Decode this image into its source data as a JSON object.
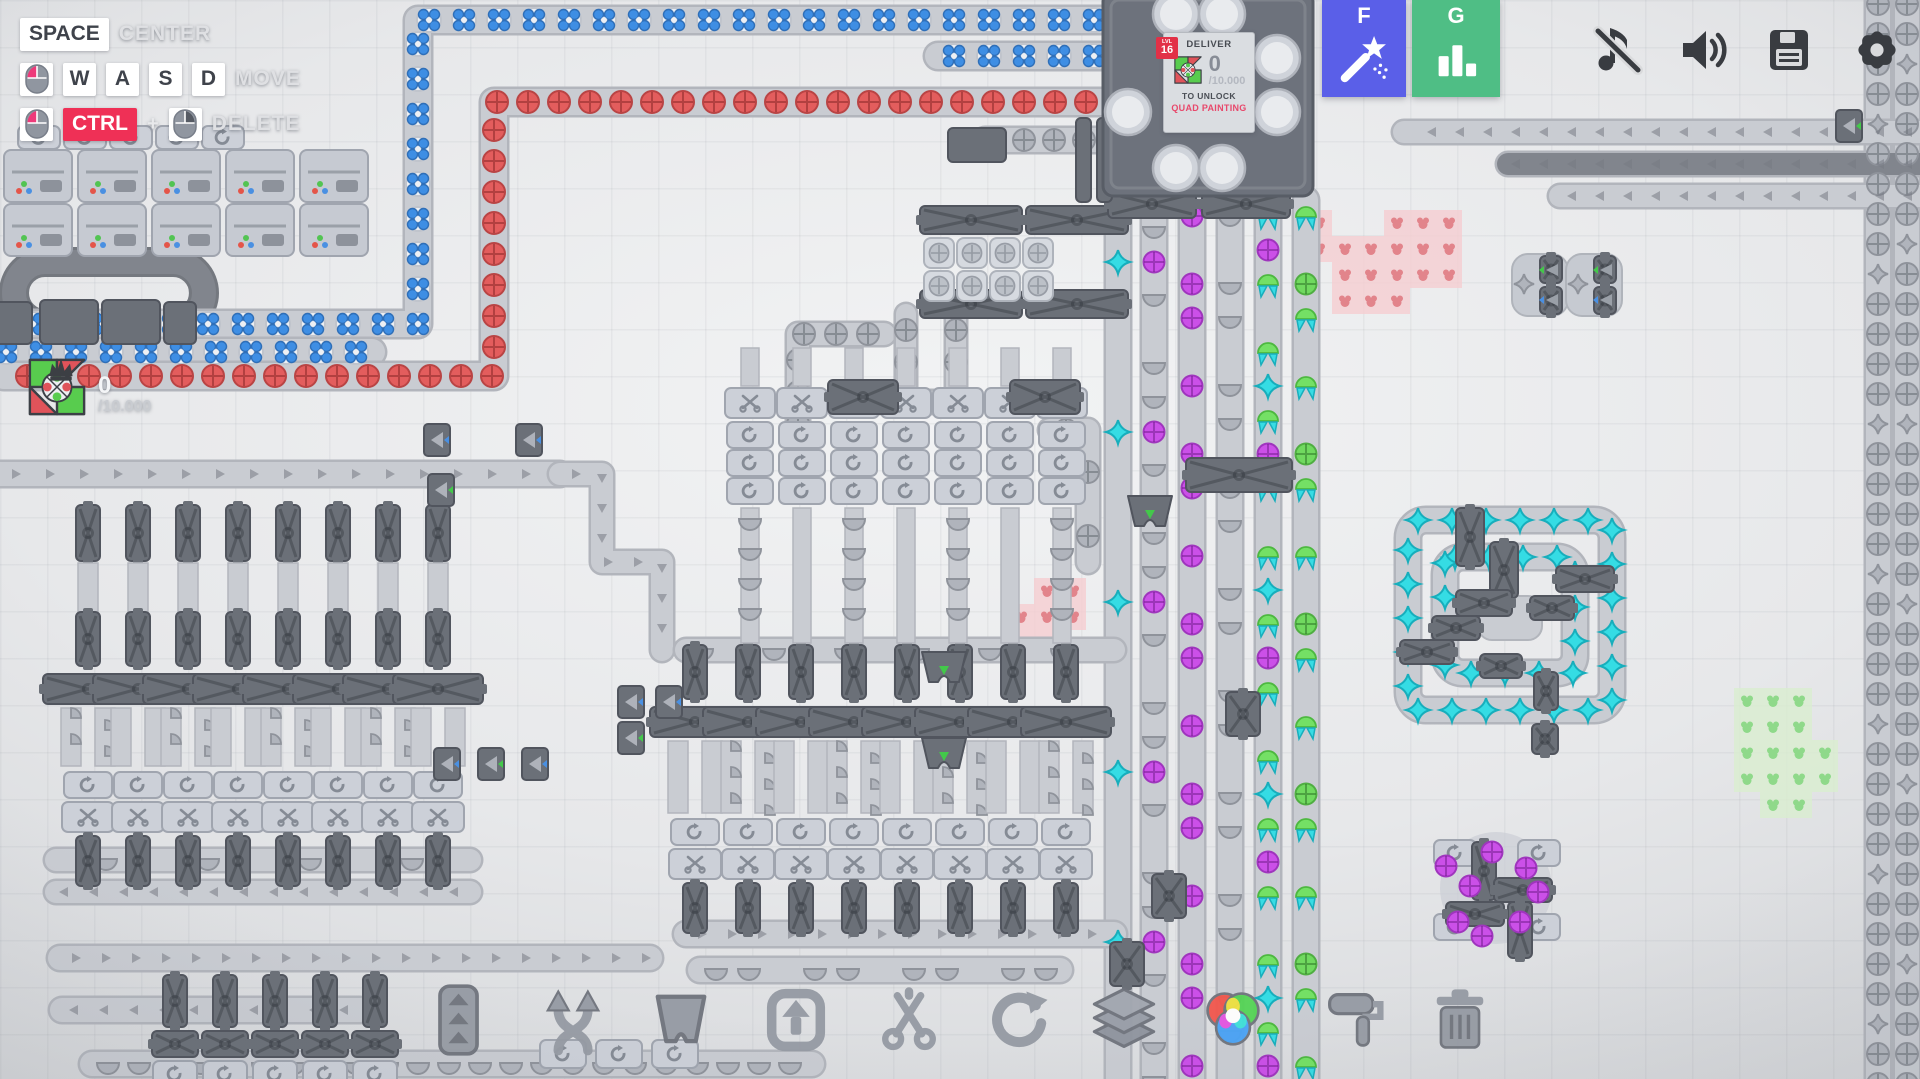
{
  "colors": {
    "accent_wand": "#5a5fe8",
    "accent_stats": "#4fbe85",
    "ctrl_chip": "#ef3056",
    "reward_text": "#e8486b",
    "item_blue": "#3e8ee4",
    "item_red": "#e35d5d",
    "item_purple": "#cb50e8",
    "item_green": "#70d95f",
    "item_cyan": "#35dce4",
    "item_gray": "#b0b4bc",
    "pink_tile": "#f5cdd1",
    "pink_dot": "#e2848b",
    "green_tile": "#daeecf",
    "green_dot": "#8fd98a",
    "machine_dark": "#6b7078",
    "machine_light": "#ccd0d8",
    "belt": "#c9ccd2"
  },
  "keybinds": {
    "space": "SPACE",
    "center": "CENTER",
    "move_keys": [
      "W",
      "A",
      "S",
      "D"
    ],
    "move": "MOVE",
    "ctrl": "CTRL",
    "plus": "+",
    "delete": "DELETE"
  },
  "hub": {
    "level_label": "LVL",
    "level": "16",
    "deliver": "DELIVER",
    "count": "0",
    "goal": "/10.000",
    "unlock": "TO UNLOCK",
    "reward": "QUAD PAINTING"
  },
  "side_counter": {
    "count": "0",
    "goal": "/10.000"
  },
  "hotkeys": {
    "wand": "F",
    "stats": "G"
  },
  "top_icons": [
    "music-muted",
    "volume",
    "save",
    "settings"
  ],
  "toolbar_icons": [
    "belt",
    "belt-swap",
    "tunnel",
    "lift",
    "cut",
    "rotate",
    "layers",
    "color-mixer",
    "paint",
    "trash"
  ],
  "scene": {
    "belts": [
      {
        "pts": [
          [
            1110,
            20
          ],
          [
            418,
            20
          ],
          [
            418,
            324
          ],
          [
            -12,
            324
          ]
        ],
        "w": 26,
        "sp": 35,
        "seq": [
          "blue-flower"
        ]
      },
      {
        "pts": [
          [
            1110,
            56
          ],
          [
            938,
            56
          ]
        ],
        "w": 26,
        "sp": 35,
        "seq": [
          "blue-flower"
        ]
      },
      {
        "pts": [
          [
            372,
            352
          ],
          [
            -12,
            352
          ]
        ],
        "w": 26,
        "sp": 35,
        "seq": [
          "blue-flower"
        ]
      },
      {
        "pts": [
          [
            1102,
            102
          ],
          [
            494,
            102
          ],
          [
            494,
            376
          ],
          [
            4,
            376
          ]
        ],
        "w": 26,
        "sp": 31,
        "seq": [
          "red-circle"
        ]
      },
      {
        "pts": [
          [
            1100,
            140
          ],
          [
            985,
            140
          ]
        ],
        "w": 24,
        "sp": 30,
        "seq": [
          "gray-circle"
        ]
      },
      {
        "pts": [
          [
            1878,
            -12
          ],
          [
            1878,
            1085
          ]
        ],
        "w": 24,
        "sp": 30,
        "seq": [
          "gray-circle",
          "gray-circle",
          "gray-circle",
          "gray-circle",
          "gray-star"
        ]
      },
      {
        "pts": [
          [
            1907,
            -12
          ],
          [
            1907,
            1085
          ]
        ],
        "w": 24,
        "sp": 30,
        "seq": [
          "gray-circle",
          "gray-circle",
          "gray-star",
          "gray-circle",
          "gray-circle",
          "gray-circle"
        ]
      },
      {
        "pts": [
          [
            1924,
            132
          ],
          [
            1404,
            132
          ]
        ],
        "w": 22,
        "sp": 28,
        "seq": [
          "chev"
        ]
      },
      {
        "pts": [
          [
            1924,
            164
          ],
          [
            1508,
            164
          ]
        ],
        "w": 22,
        "sp": 28,
        "seq": [
          "chev"
        ],
        "dark": true
      },
      {
        "pts": [
          [
            1924,
            196
          ],
          [
            1560,
            196
          ]
        ],
        "w": 22,
        "sp": 28,
        "seq": [
          "chev"
        ]
      },
      {
        "pts": [
          [
            1118,
            212
          ],
          [
            1118,
            1085
          ]
        ],
        "w": 24,
        "sp": 34,
        "seq": [
          "none",
          "cyan-star",
          "none",
          "none",
          "none"
        ]
      },
      {
        "pts": [
          [
            1154,
            212
          ],
          [
            1154,
            1085
          ]
        ],
        "w": 24,
        "sp": 34,
        "seq": [
          "gray-half",
          "purple-circle",
          "gray-half",
          "none",
          "gray-half"
        ]
      },
      {
        "pts": [
          [
            1192,
            200
          ],
          [
            1192,
            1085
          ]
        ],
        "w": 24,
        "sp": 34,
        "seq": [
          "purple-circle",
          "none",
          "purple-circle",
          "purple-circle",
          "none"
        ]
      },
      {
        "pts": [
          [
            1230,
            200
          ],
          [
            1230,
            1085
          ]
        ],
        "w": 24,
        "sp": 34,
        "seq": [
          "gray-half",
          "none",
          "gray-half",
          "gray-half",
          "none",
          "gray-half"
        ]
      },
      {
        "pts": [
          [
            1268,
            200
          ],
          [
            1268,
            1085
          ]
        ],
        "w": 24,
        "sp": 34,
        "seq": [
          "green-moth",
          "purple-circle",
          "green-moth",
          "none",
          "green-moth",
          "cyan-star"
        ]
      },
      {
        "pts": [
          [
            1306,
            200
          ],
          [
            1306,
            1085
          ]
        ],
        "w": 24,
        "sp": 34,
        "seq": [
          "green-moth",
          "none",
          "green-circle",
          "green-moth",
          "none"
        ]
      },
      {
        "pts": [
          [
            884,
            334
          ],
          [
            798,
            334
          ],
          [
            798,
            476
          ]
        ],
        "w": 22,
        "sp": 32,
        "seq": [
          "gray-circle"
        ]
      },
      {
        "pts": [
          [
            852,
            402
          ],
          [
            940,
            402
          ]
        ],
        "w": 22,
        "sp": 32,
        "seq": [
          "gray-circle",
          "gray-circle",
          "none"
        ]
      },
      {
        "pts": [
          [
            906,
            314
          ],
          [
            906,
            388
          ]
        ],
        "w": 20,
        "sp": 32,
        "seq": [
          "gray-circle"
        ]
      },
      {
        "pts": [
          [
            956,
            314
          ],
          [
            956,
            388
          ]
        ],
        "w": 20,
        "sp": 32,
        "seq": [
          "gray-circle"
        ]
      },
      {
        "pts": [
          [
            1050,
            430
          ],
          [
            1088,
            430
          ],
          [
            1088,
            562
          ]
        ],
        "w": 22,
        "sp": 32,
        "seq": [
          "gray-circle",
          "none"
        ]
      },
      {
        "pts": [
          [
            0,
            474
          ],
          [
            560,
            474
          ]
        ],
        "w": 24,
        "sp": 34,
        "seq": [
          "chev"
        ]
      },
      {
        "pts": [
          [
            560,
            474
          ],
          [
            602,
            474
          ],
          [
            602,
            562
          ],
          [
            662,
            562
          ],
          [
            662,
            650
          ]
        ],
        "w": 22,
        "sp": 30,
        "seq": [
          "chev"
        ]
      },
      {
        "pts": [
          [
            470,
            892
          ],
          [
            56,
            892
          ]
        ],
        "w": 22,
        "sp": 30,
        "seq": [
          "chev"
        ]
      },
      {
        "pts": [
          [
            56,
            860
          ],
          [
            470,
            860
          ]
        ],
        "w": 22,
        "sp": 34,
        "seq": [
          "none",
          "gray-half",
          "none"
        ]
      },
      {
        "pts": [
          [
            60,
            958
          ],
          [
            650,
            958
          ]
        ],
        "w": 24,
        "sp": 30,
        "seq": [
          "chev"
        ]
      },
      {
        "pts": [
          [
            92,
            1064
          ],
          [
            812,
            1064
          ]
        ],
        "w": 24,
        "sp": 31,
        "seq": [
          "gray-half"
        ]
      },
      {
        "pts": [
          [
            686,
            650
          ],
          [
            1114,
            650
          ]
        ],
        "w": 22,
        "sp": 36,
        "seq": [
          "gray-half",
          "none"
        ]
      },
      {
        "pts": [
          [
            686,
            934
          ],
          [
            1114,
            934
          ]
        ],
        "w": 24,
        "sp": 30,
        "seq": [
          "chev"
        ]
      },
      {
        "pts": [
          [
            700,
            970
          ],
          [
            1060,
            970
          ]
        ],
        "w": 24,
        "sp": 33,
        "seq": [
          "gray-half",
          "gray-half",
          "none"
        ]
      },
      {
        "pts": [
          [
            360,
            1010
          ],
          [
            62,
            1010
          ]
        ],
        "w": 24,
        "sp": 30,
        "seq": [
          "chev"
        ]
      }
    ],
    "loop": {
      "x": 14,
      "y": 262,
      "w": 190,
      "h": 62
    },
    "xsplits": [
      [
        920,
        206,
        102,
        28
      ],
      [
        1026,
        206,
        102,
        28
      ],
      [
        920,
        290,
        102,
        28
      ],
      [
        1026,
        290,
        102,
        28
      ],
      [
        828,
        380,
        70,
        34
      ],
      [
        1010,
        380,
        70,
        34
      ],
      [
        1108,
        190,
        88,
        28
      ],
      [
        1202,
        190,
        88,
        28
      ],
      [
        1186,
        458,
        106,
        34
      ],
      [
        1110,
        942,
        34,
        44
      ],
      [
        1226,
        692,
        34,
        44
      ],
      [
        1152,
        874,
        34,
        44
      ]
    ],
    "blocks": [
      [
        948,
        128,
        58,
        34
      ],
      [
        1076,
        118,
        15,
        84
      ],
      [
        1097,
        118,
        15,
        84
      ],
      [
        -6,
        302,
        38,
        42
      ],
      [
        40,
        300,
        58,
        44
      ],
      [
        102,
        300,
        58,
        44
      ],
      [
        164,
        302,
        32,
        42
      ]
    ],
    "grid": {
      "x": 924,
      "y": 238,
      "cols": 4,
      "rows": 2,
      "s": 33
    },
    "traps": [
      [
        1128,
        496
      ],
      [
        922,
        652
      ],
      [
        922,
        738
      ]
    ],
    "tunnels": [
      [
        424,
        424,
        "b"
      ],
      [
        516,
        424,
        "b"
      ],
      [
        428,
        474,
        "g"
      ],
      [
        618,
        686,
        "b"
      ],
      [
        656,
        686,
        "b"
      ],
      [
        618,
        722,
        "g"
      ],
      [
        434,
        748,
        "b"
      ],
      [
        478,
        748,
        "g"
      ],
      [
        522,
        748,
        "b"
      ],
      [
        1836,
        110,
        "g"
      ]
    ],
    "pads": [
      [
        540,
        1040
      ],
      [
        596,
        1040
      ],
      [
        652,
        1040
      ]
    ],
    "painters": {
      "x0": 4,
      "dx": 74,
      "n": 5,
      "rows": [
        150,
        204
      ]
    },
    "minirots": {
      "x0": 18,
      "dx": 46,
      "n": 5,
      "y": 126
    },
    "banks": {
      "left": {
        "x0": 88,
        "dx": 50,
        "n": 8,
        "pre": 505,
        "y0": 612,
        "beltLen": 58
      },
      "center": {
        "x0": 695,
        "dx": 53,
        "n": 8,
        "y0": 645,
        "beltLen": 72
      },
      "top": {
        "x0": 750,
        "dx": 52,
        "n": 7
      },
      "strip": {
        "x0": 175,
        "dx": 50,
        "n": 5
      }
    },
    "hub": {
      "x": 1103,
      "y": -8,
      "w": 210,
      "h": 204,
      "pads": [
        [
          1176,
          14
        ],
        [
          1222,
          14
        ],
        [
          1128,
          112
        ],
        [
          1277,
          58
        ],
        [
          1277,
          112
        ],
        [
          1176,
          168
        ],
        [
          1222,
          168
        ]
      ]
    },
    "spiral": {
      "x": 1408,
      "y": 520,
      "w": 204,
      "h": 190,
      "sp": 34,
      "splitters": [
        [
          1456,
          508,
          28,
          58
        ],
        [
          1490,
          542,
          28,
          56
        ],
        [
          1556,
          566,
          58,
          26
        ],
        [
          1456,
          590,
          56,
          26
        ],
        [
          1530,
          596,
          44,
          24
        ],
        [
          1432,
          616,
          48,
          24
        ],
        [
          1400,
          640,
          54,
          24
        ],
        [
          1480,
          654,
          42,
          24
        ],
        [
          1534,
          672,
          24,
          38
        ],
        [
          1532,
          724,
          26,
          30
        ]
      ]
    },
    "pinwheel": {
      "cx": 1496,
      "cy": 888
    },
    "patches": [
      {
        "x": 1306,
        "y": 210,
        "t": 26,
        "c": "pink",
        "rows": [
          [
            0,
            3,
            4,
            5
          ],
          [
            0,
            1,
            2,
            3,
            4,
            5
          ],
          [
            1,
            2,
            3,
            4,
            5
          ],
          [
            1,
            2,
            3
          ]
        ]
      },
      {
        "x": 1008,
        "y": 578,
        "t": 26,
        "c": "pink",
        "rows": [
          [
            1,
            2
          ],
          [
            0,
            1,
            2
          ],
          [
            0,
            1
          ]
        ]
      },
      {
        "x": 1734,
        "y": 688,
        "t": 26,
        "c": "green",
        "rows": [
          [
            0,
            1,
            2
          ],
          [
            0,
            1,
            2
          ],
          [
            0,
            1,
            2,
            3
          ],
          [
            0,
            1,
            2,
            3
          ],
          [
            1,
            2
          ]
        ]
      }
    ],
    "tpairs": [
      [
        1538,
        256
      ],
      [
        1592,
        256
      ]
    ]
  }
}
